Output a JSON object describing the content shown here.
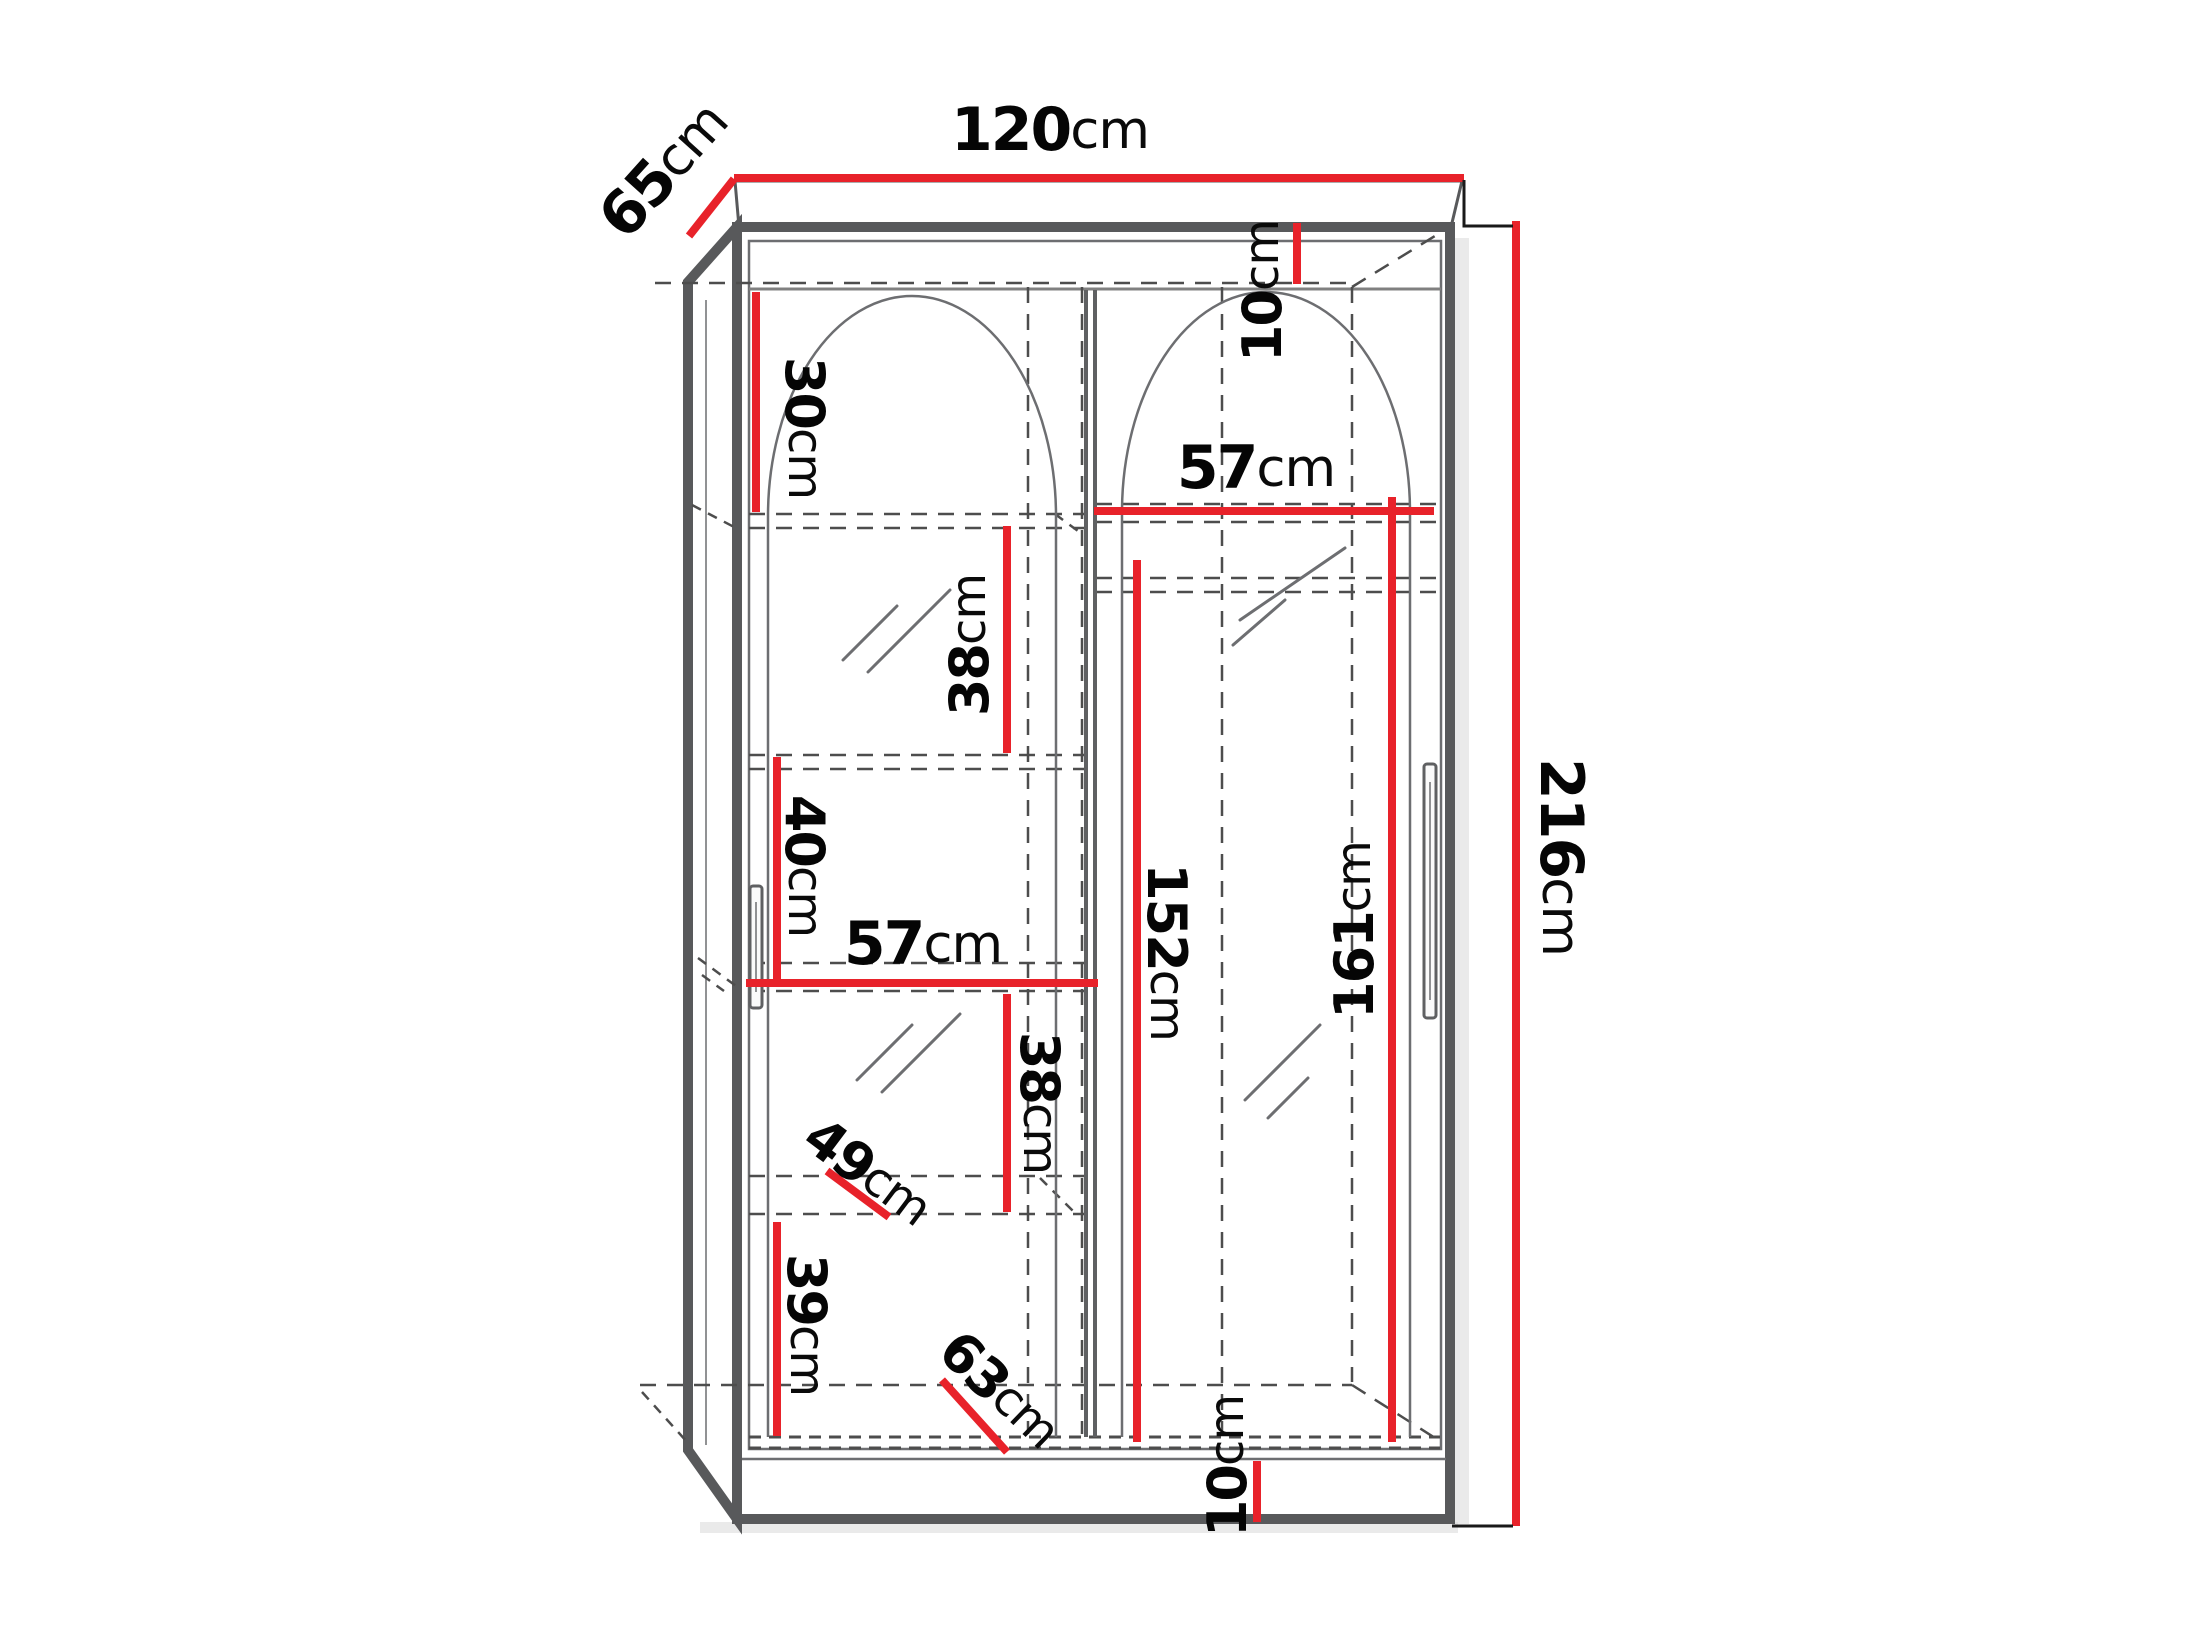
{
  "diagram": {
    "kind": "wardrobe-dimension-drawing",
    "unit": "cm",
    "colors": {
      "dimension_line": "#e8222a",
      "cabinet_outline": "#58595b",
      "hidden_line": "#4d4d4d",
      "label_text": "#000000",
      "background": "#ffffff"
    }
  },
  "dimensions": {
    "overall_width": {
      "value": "120",
      "unit": "cm"
    },
    "overall_depth": {
      "value": "65",
      "unit": "cm"
    },
    "overall_height": {
      "value": "216",
      "unit": "cm"
    },
    "top_clearance": {
      "value": "10",
      "unit": "cm"
    },
    "upper_left_section": {
      "value": "30",
      "unit": "cm"
    },
    "right_shelf_width": {
      "value": "57",
      "unit": "cm"
    },
    "left_gap_upper": {
      "value": "38",
      "unit": "cm"
    },
    "right_inner_height": {
      "value": "161",
      "unit": "cm"
    },
    "right_hanging_height": {
      "value": "152",
      "unit": "cm"
    },
    "left_gap_middle": {
      "value": "40",
      "unit": "cm"
    },
    "left_shelf_width": {
      "value": "57",
      "unit": "cm"
    },
    "left_gap_lower": {
      "value": "38",
      "unit": "cm"
    },
    "left_shelf_depth": {
      "value": "49",
      "unit": "cm"
    },
    "left_bottom_section": {
      "value": "39",
      "unit": "cm"
    },
    "bottom_depth": {
      "value": "63",
      "unit": "cm"
    },
    "plinth_height": {
      "value": "10",
      "unit": "cm"
    }
  }
}
